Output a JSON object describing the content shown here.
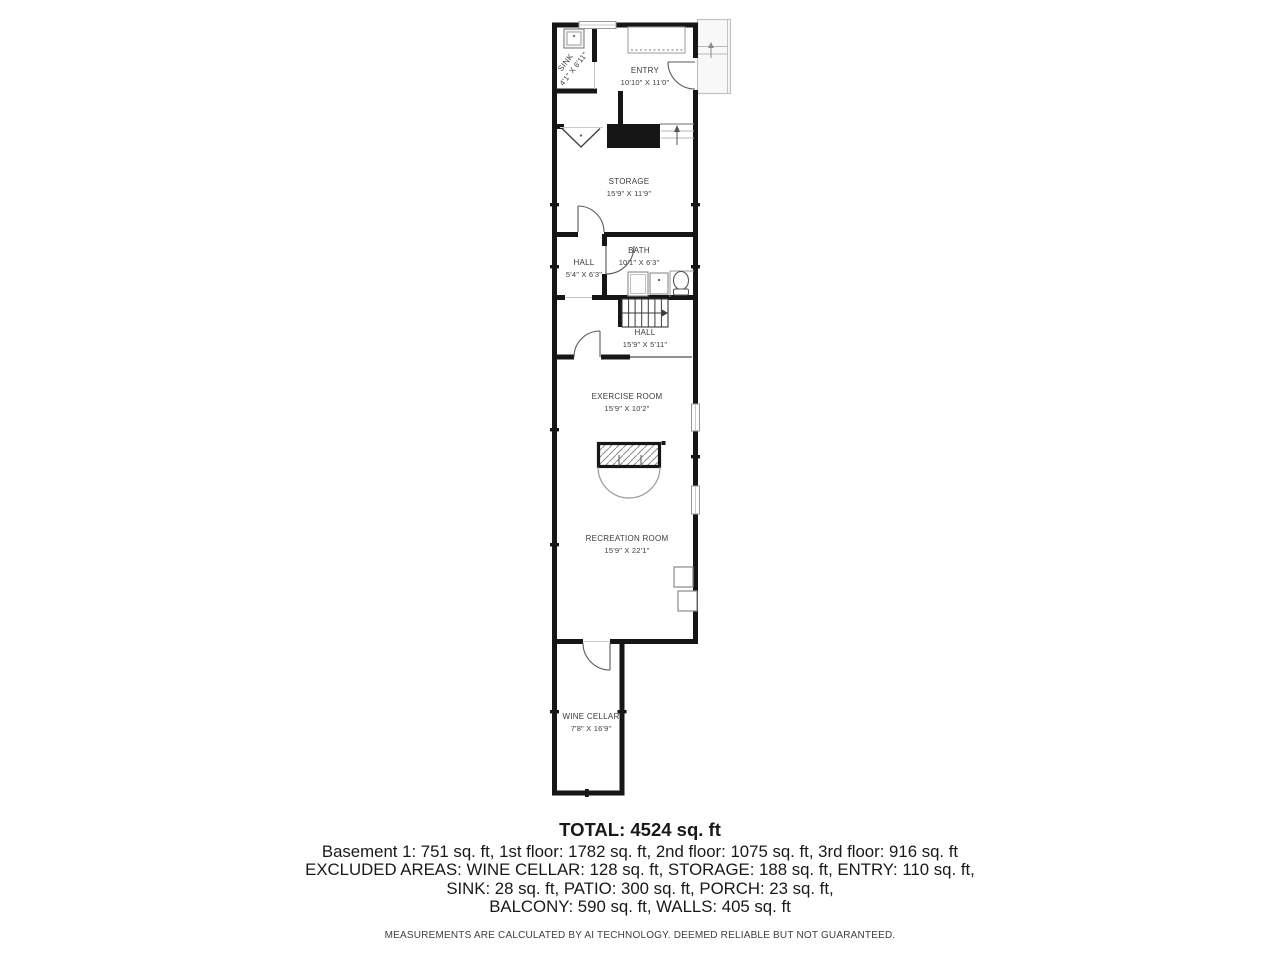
{
  "floorplan": {
    "colors": {
      "wall": "#161616",
      "fixture": "#8a8a8a",
      "label": "#3b3b3b",
      "porch_fill": "#f8f8f8"
    },
    "rooms": [
      {
        "id": "sink",
        "name": "SINK",
        "dims": "4'1\" X 6'11\""
      },
      {
        "id": "entry",
        "name": "ENTRY",
        "dims": "10'10\" X 11'0\""
      },
      {
        "id": "storage",
        "name": "STORAGE",
        "dims": "15'9\" X 11'9\""
      },
      {
        "id": "hall-upper",
        "name": "HALL",
        "dims": "5'4\" X 6'3\""
      },
      {
        "id": "bath",
        "name": "BATH",
        "dims": "10'1\" X 6'3\""
      },
      {
        "id": "hall-lower",
        "name": "HALL",
        "dims": "15'9\" X 5'11\""
      },
      {
        "id": "exercise",
        "name": "EXERCISE ROOM",
        "dims": "15'9\" X 10'2\""
      },
      {
        "id": "recreation",
        "name": "RECREATION ROOM",
        "dims": "15'9\" X 22'1\""
      },
      {
        "id": "wine-cellar",
        "name": "WINE CELLAR",
        "dims": "7'8\" X 16'9\""
      }
    ]
  },
  "summary": {
    "total": "TOTAL: 4524 sq. ft",
    "floors": "Basement 1: 751 sq. ft, 1st floor: 1782 sq. ft, 2nd floor: 1075 sq. ft, 3rd floor: 916 sq. ft",
    "excluded1": "EXCLUDED AREAS: WINE CELLAR: 128 sq. ft, STORAGE: 188 sq. ft, ENTRY: 110 sq. ft,",
    "excluded2": "SINK: 28 sq. ft, PATIO: 300 sq. ft, PORCH: 23 sq. ft,",
    "excluded3": "BALCONY: 590 sq. ft, WALLS: 405 sq. ft",
    "disclaimer": "MEASUREMENTS ARE CALCULATED BY AI TECHNOLOGY. DEEMED RELIABLE BUT NOT GUARANTEED."
  }
}
